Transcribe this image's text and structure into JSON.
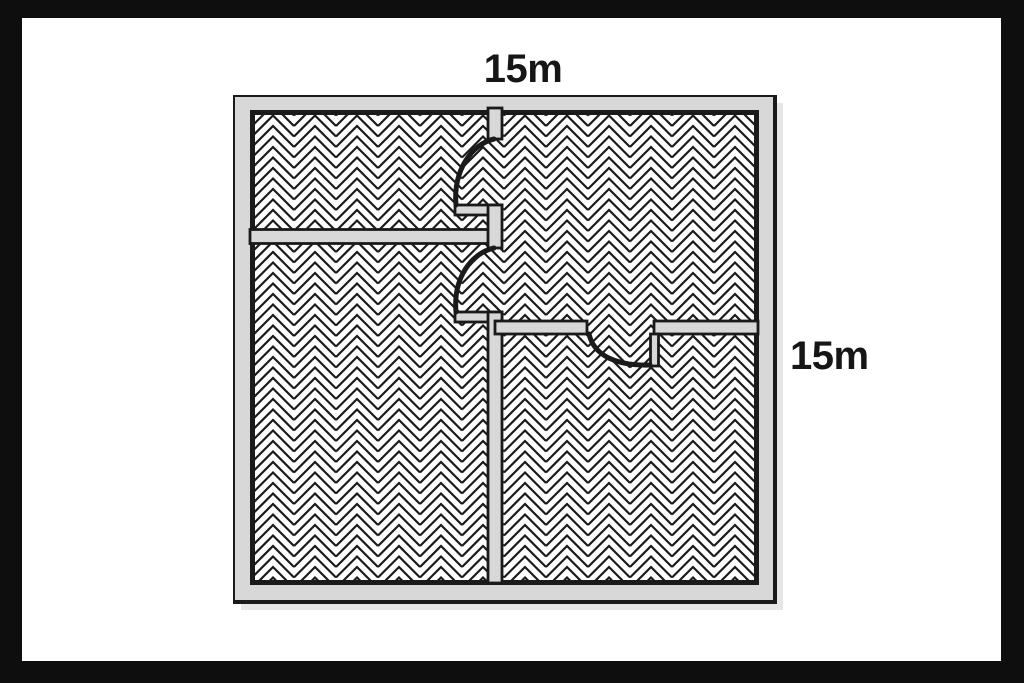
{
  "page": {
    "frame_color": "#0e0e0e",
    "background": "#ffffff"
  },
  "floor_plan": {
    "top_dimension_label": "15m",
    "right_dimension_label": "15m",
    "floor_pattern": "herringbone",
    "wall_fill": "#d8d8d8",
    "line_color": "#1a1a1a",
    "shadow_color": "#e6e6e6",
    "floor_background": "#ffffff"
  }
}
